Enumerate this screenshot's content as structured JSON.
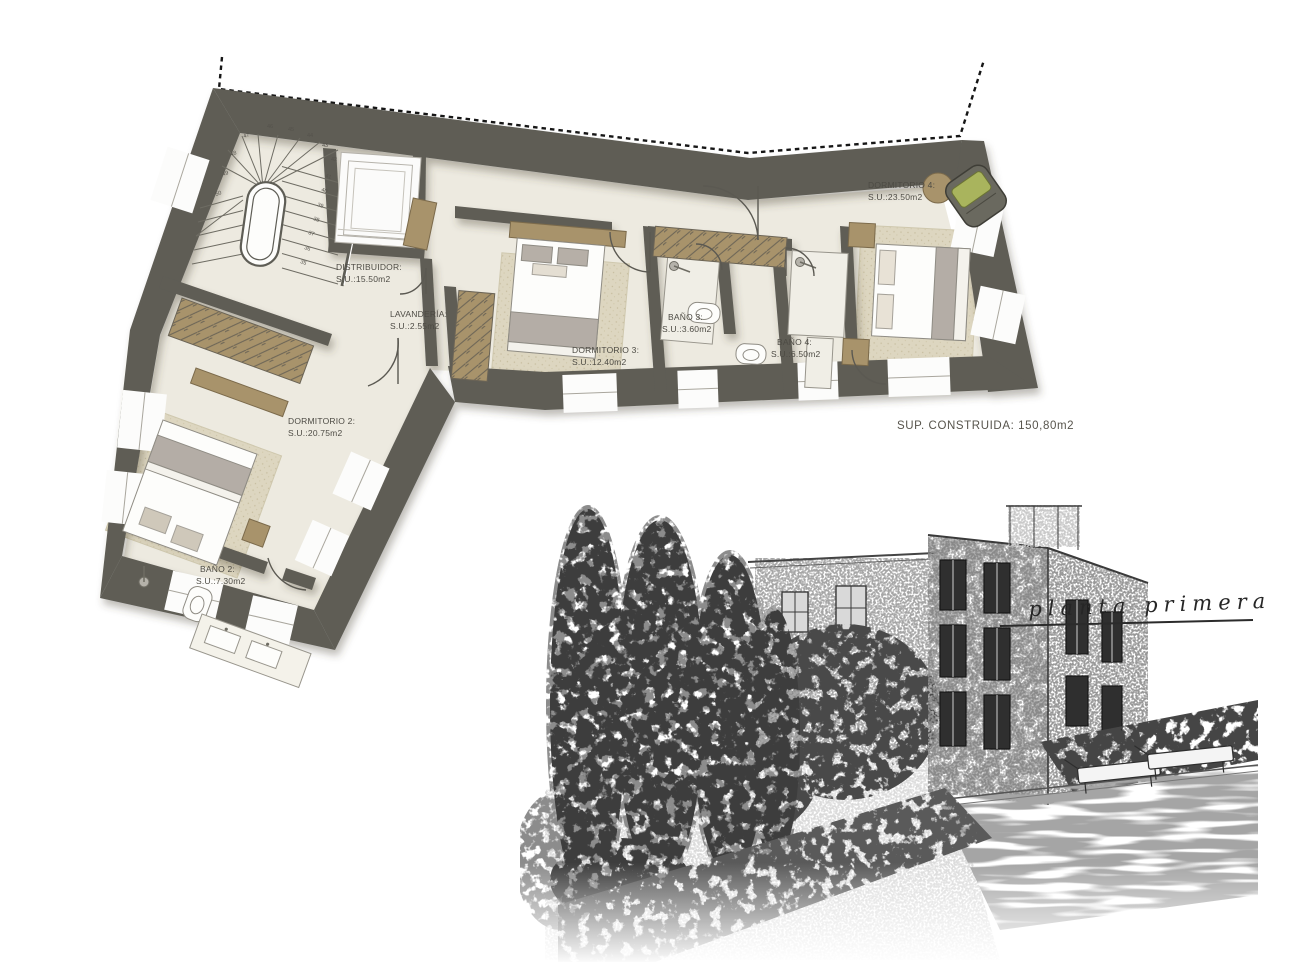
{
  "sheet": {
    "type": "architectural-floor-plan",
    "background": "#ffffff"
  },
  "floor_plan": {
    "rooms": [
      {
        "id": "distribuidor",
        "name": "DISTRIBUIDOR:",
        "area": "S.U.:15.50m2"
      },
      {
        "id": "lavanderia",
        "name": "LAVANDERÍA:",
        "area": "S.U.:2.55m2"
      },
      {
        "id": "dormitorio3",
        "name": "DORMITORIO 3:",
        "area": "S.U.:12.40m2"
      },
      {
        "id": "bano3",
        "name": "BAÑO 3:",
        "area": "S.U.:3.60m2"
      },
      {
        "id": "bano4",
        "name": "BAÑO 4:",
        "area": "S.U.:6.50m2"
      },
      {
        "id": "dormitorio4",
        "name": "DORMITORIO 4:",
        "area": "S.U.:23.50m2"
      },
      {
        "id": "dormitorio2",
        "name": "DORMITORIO 2:",
        "area": "S.U.:20.75m2"
      },
      {
        "id": "bano2",
        "name": "BAÑO 2:",
        "area": "S.U.:7.30m2"
      }
    ],
    "total_area_label": "SUP.  CONSTRUIDA: 150,80m2",
    "stair_step_numbers": [
      35,
      36,
      37,
      38,
      39,
      40,
      41,
      42,
      43,
      44,
      45,
      46,
      47,
      48,
      49,
      50
    ],
    "colors": {
      "wall": "#5e5d55",
      "floor": "#edeae0",
      "rug": "#ddd6c0",
      "furniture_tan": "#a8936b",
      "cushion_green": "#a9b45d",
      "blanket_gray": "#b4ada6"
    }
  },
  "sketch": {
    "caption": "planta primera"
  }
}
